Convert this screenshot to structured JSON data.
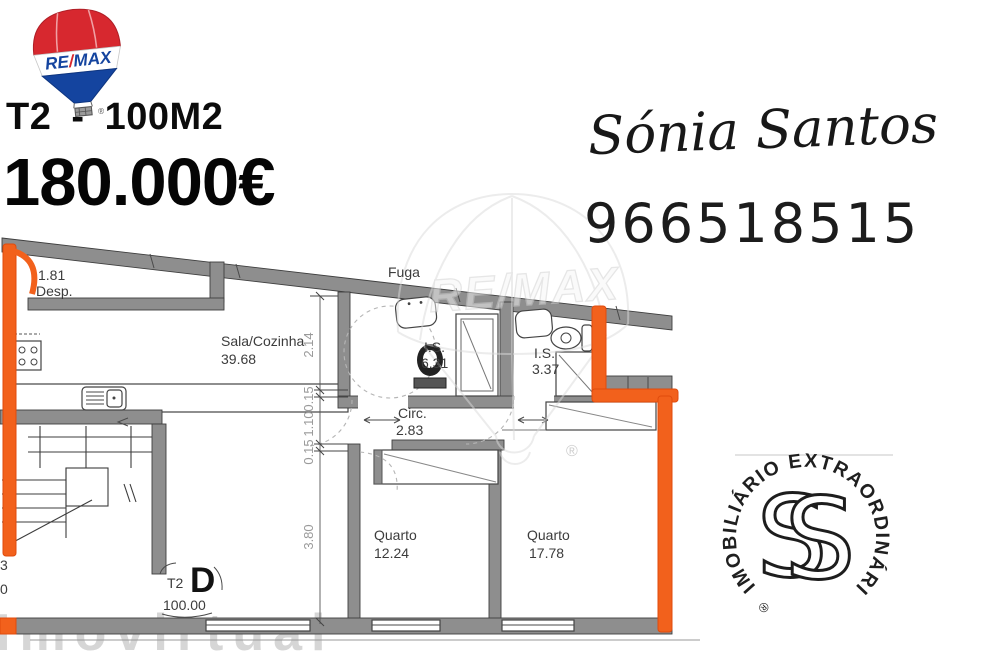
{
  "header": {
    "logo": {
      "re": "RE",
      "slash": "/",
      "max": "MAX",
      "registered": "®"
    },
    "listing_title": "T2 - 100M2",
    "price": "180.000€"
  },
  "agent": {
    "name": "Sónia Santos",
    "phone": "966518515"
  },
  "floor_plan": {
    "escape_label": "Fuga",
    "rooms": [
      {
        "name": "Desp.",
        "area": "1.81"
      },
      {
        "name": "Sala/Cozinha",
        "area": "39.68"
      },
      {
        "name": "I.S.",
        "area": "6.31"
      },
      {
        "name": "I.S.",
        "area": "3.37"
      },
      {
        "name": "Circ.",
        "area": "2.83"
      },
      {
        "name": "Quarto",
        "area": "12.24"
      },
      {
        "name": "Quarto",
        "area": "17.78"
      }
    ],
    "unit": {
      "type": "T2",
      "letter": "D",
      "total_area": "100.00"
    },
    "dimensions": {
      "left_chain": [
        "2.14",
        "0.15",
        "1.10",
        "0.15",
        "3.80"
      ]
    },
    "edge_fragments": {
      "top": "3",
      "bottom": "0"
    },
    "highlight_color": "#f2611c"
  },
  "watermarks": {
    "center_brand": "RE/MAX",
    "portal": "Imovirtual",
    "registered": "®"
  },
  "stamp": {
    "circular_text": "IMOBILIÁRIO EXTRAORDINÁRIO",
    "registered": "®",
    "monogram": "S"
  }
}
